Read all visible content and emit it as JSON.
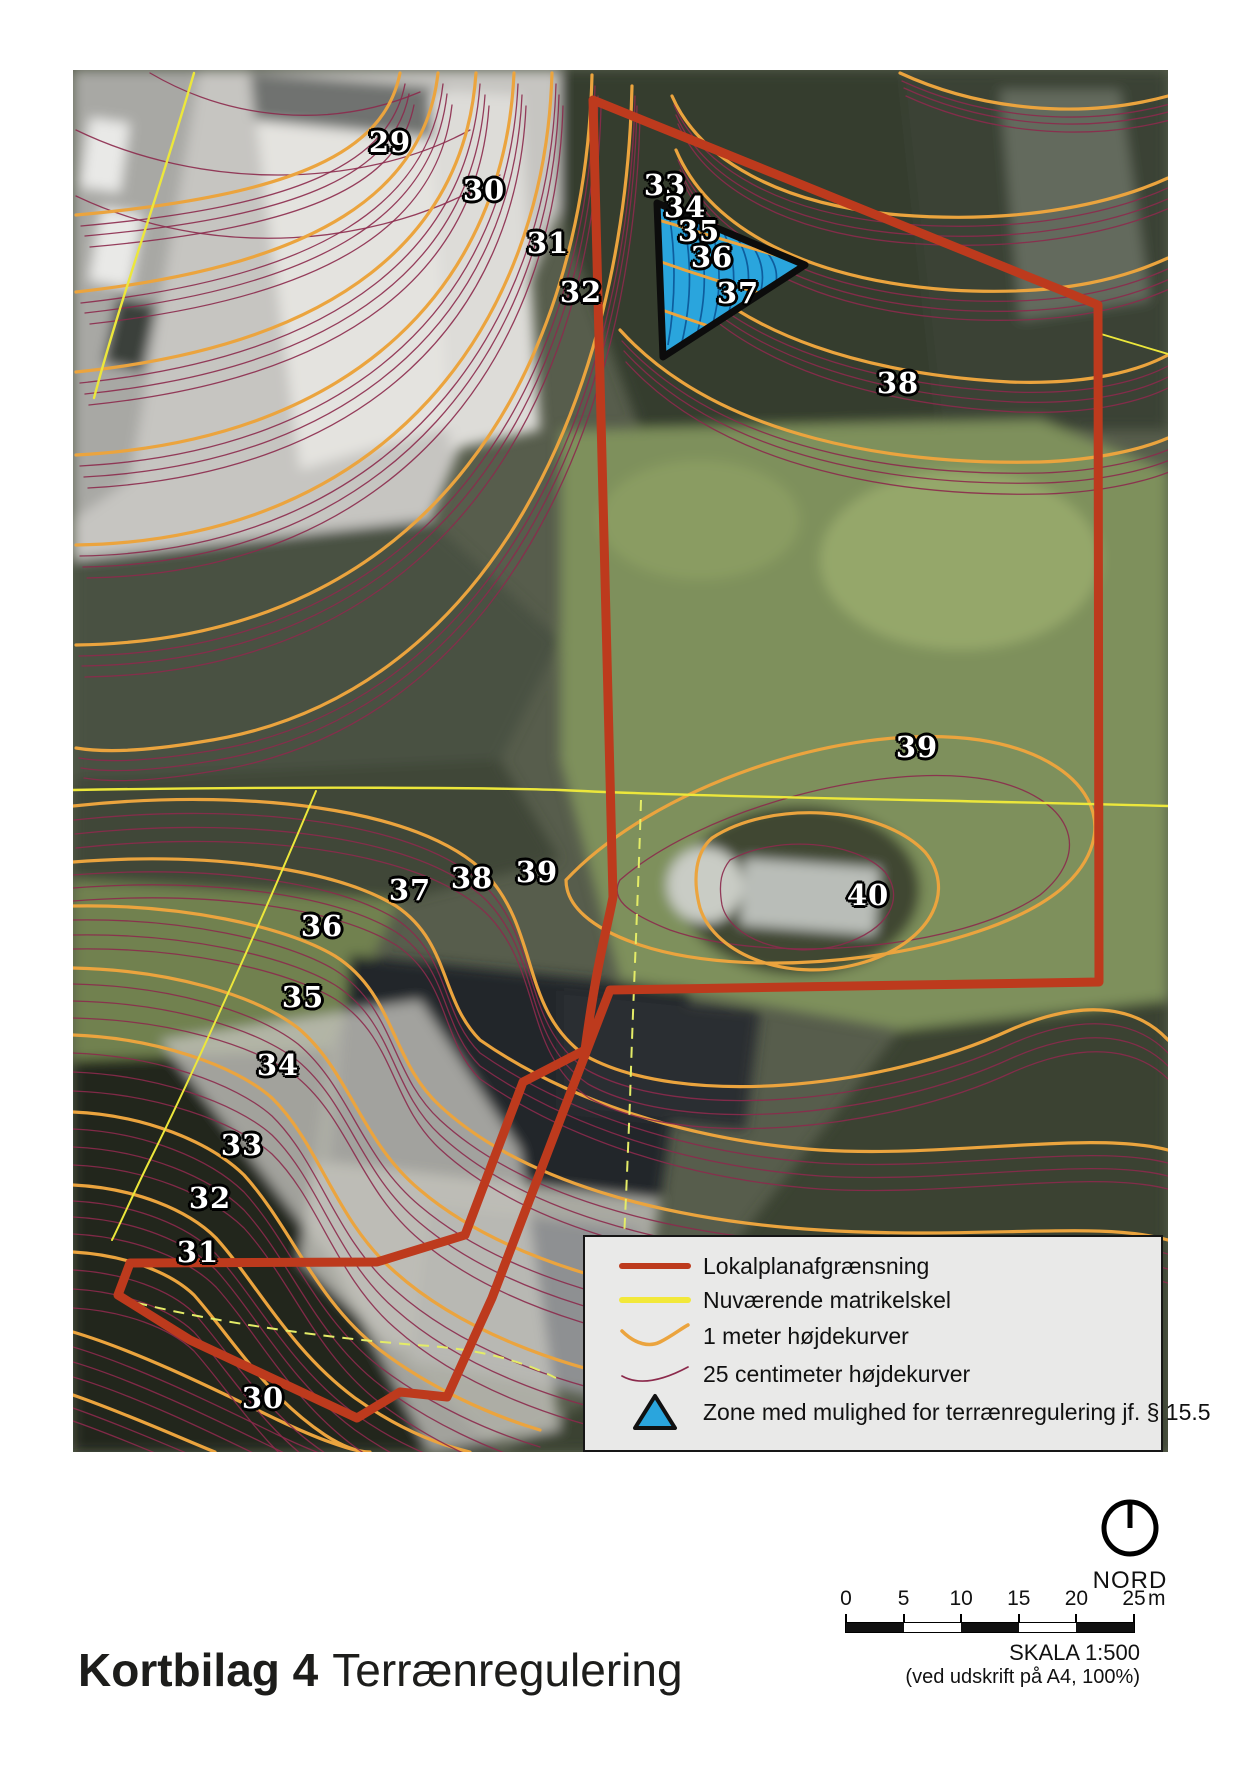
{
  "page": {
    "title_bold": "Kortbilag 4",
    "title_regular": "Terrænregulering"
  },
  "legend": {
    "items": [
      {
        "label": "Lokalplanafgrænsning",
        "symbol": "thick-red-line"
      },
      {
        "label": "Nuværende matrikelskel",
        "symbol": "yellow-line"
      },
      {
        "label": "1 meter højdekurver",
        "symbol": "orange-contour-curve"
      },
      {
        "label": "25 centimeter højdekurver",
        "symbol": "purple-contour-curve"
      },
      {
        "label": "Zone med mulighed for terrænregulering jf.  § 15.5",
        "symbol": "blue-triangle"
      }
    ]
  },
  "north": {
    "label": "NORD"
  },
  "scale": {
    "ticks": [
      "0",
      "5",
      "10",
      "15",
      "20",
      "25"
    ],
    "unit": "m",
    "text": "SKALA 1:500",
    "subtext": "(ved udskrift på A4, 100%)"
  },
  "map": {
    "elevation_labels": [
      {
        "text": "29",
        "x": 390,
        "y": 142
      },
      {
        "text": "30",
        "x": 484,
        "y": 190
      },
      {
        "text": "31",
        "x": 548,
        "y": 243
      },
      {
        "text": "32",
        "x": 581,
        "y": 292
      },
      {
        "text": "33",
        "x": 665,
        "y": 185
      },
      {
        "text": "34",
        "x": 685,
        "y": 207
      },
      {
        "text": "35",
        "x": 699,
        "y": 231
      },
      {
        "text": "36",
        "x": 712,
        "y": 257
      },
      {
        "text": "37",
        "x": 738,
        "y": 293
      },
      {
        "text": "38",
        "x": 898,
        "y": 383
      },
      {
        "text": "39",
        "x": 917,
        "y": 747
      },
      {
        "text": "40",
        "x": 868,
        "y": 895
      },
      {
        "text": "37",
        "x": 410,
        "y": 890
      },
      {
        "text": "38",
        "x": 472,
        "y": 878
      },
      {
        "text": "39",
        "x": 537,
        "y": 872
      },
      {
        "text": "36",
        "x": 322,
        "y": 926
      },
      {
        "text": "35",
        "x": 303,
        "y": 997
      },
      {
        "text": "34",
        "x": 278,
        "y": 1065
      },
      {
        "text": "33",
        "x": 242,
        "y": 1145
      },
      {
        "text": "32",
        "x": 210,
        "y": 1198
      },
      {
        "text": "31",
        "x": 198,
        "y": 1252
      },
      {
        "text": "30",
        "x": 263,
        "y": 1398
      }
    ]
  },
  "colors": {
    "boundary": "#bd3a1d",
    "matrikelskel": "#ece73b",
    "contour_1m": "#eba43e",
    "contour_25cm": "#8c2a4c",
    "zone_fill": "#2aa5dd"
  }
}
